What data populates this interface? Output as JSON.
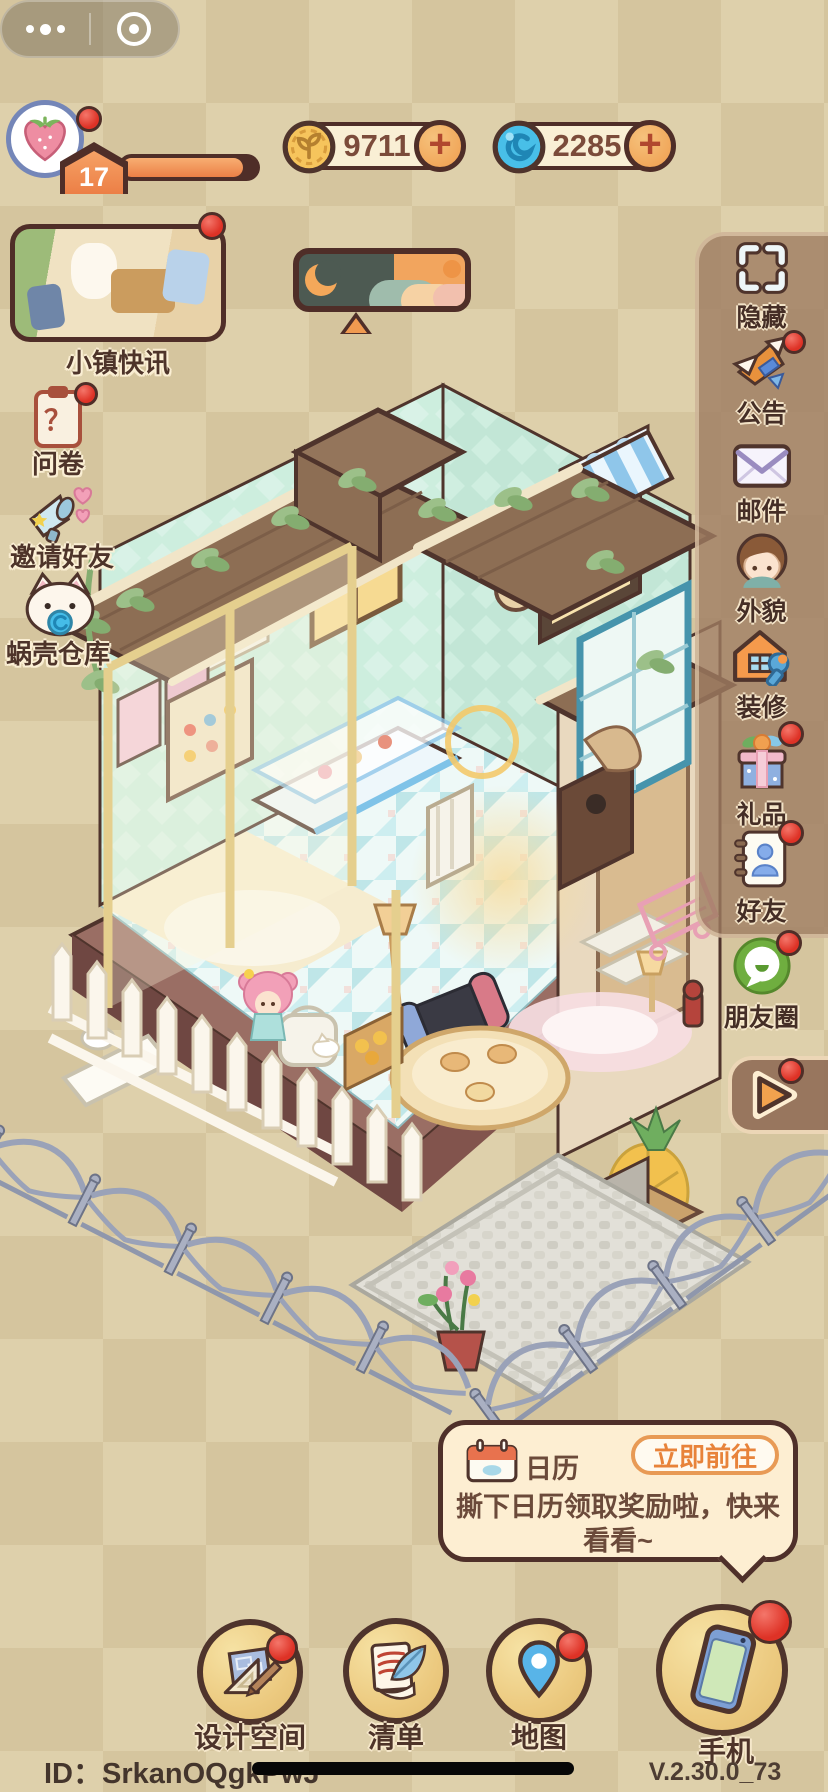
{
  "colors": {
    "background_tan": "#d6c7a0",
    "panel_brown": "#9e7c61",
    "badge_red": "#de3226",
    "accent_orange": "#e8833a",
    "pill_cream": "#f9efd5",
    "outline_brown": "#4f2e28"
  },
  "header": {
    "level": "17",
    "xp_percent": 90,
    "currencies": [
      {
        "id": "coin",
        "icon": "gold-coin",
        "value": "9711"
      },
      {
        "id": "shell",
        "icon": "blue-shell-swirl",
        "value": "2285"
      }
    ]
  },
  "left_menu": {
    "news_label": "小镇快讯",
    "survey": {
      "label": "问卷",
      "glyph": "？"
    },
    "invite": {
      "label": "邀请好友"
    },
    "warehouse": {
      "label": "蜗壳仓库"
    }
  },
  "right_menu": {
    "items": [
      {
        "id": "hide",
        "label": "隐藏",
        "badge": false
      },
      {
        "id": "announcement",
        "label": "公告",
        "badge": true
      },
      {
        "id": "mail",
        "label": "邮件",
        "badge": false
      },
      {
        "id": "appearance",
        "label": "外貌",
        "badge": false
      },
      {
        "id": "decorate",
        "label": "装修",
        "badge": false
      },
      {
        "id": "gift",
        "label": "礼品",
        "badge": true
      },
      {
        "id": "friends",
        "label": "好友",
        "badge": true
      },
      {
        "id": "moments",
        "label": "朋友圈",
        "badge": true
      }
    ]
  },
  "play_tab": {
    "badge": true
  },
  "notice": {
    "icon": "calendar",
    "title": "日历",
    "action_label": "立即前往",
    "message": "撕下日历领取奖励啦，快来看看~"
  },
  "bottom_bar": {
    "items": [
      {
        "id": "design",
        "label": "设计空间",
        "badge": true
      },
      {
        "id": "checklist",
        "label": "清单",
        "badge": false
      },
      {
        "id": "map",
        "label": "地图",
        "badge": true
      },
      {
        "id": "phone",
        "label": "手机",
        "badge": true
      }
    ]
  },
  "footer": {
    "player_id": "ID：SrkanOQgkPwJ",
    "version": "V.2.30.0_73"
  }
}
